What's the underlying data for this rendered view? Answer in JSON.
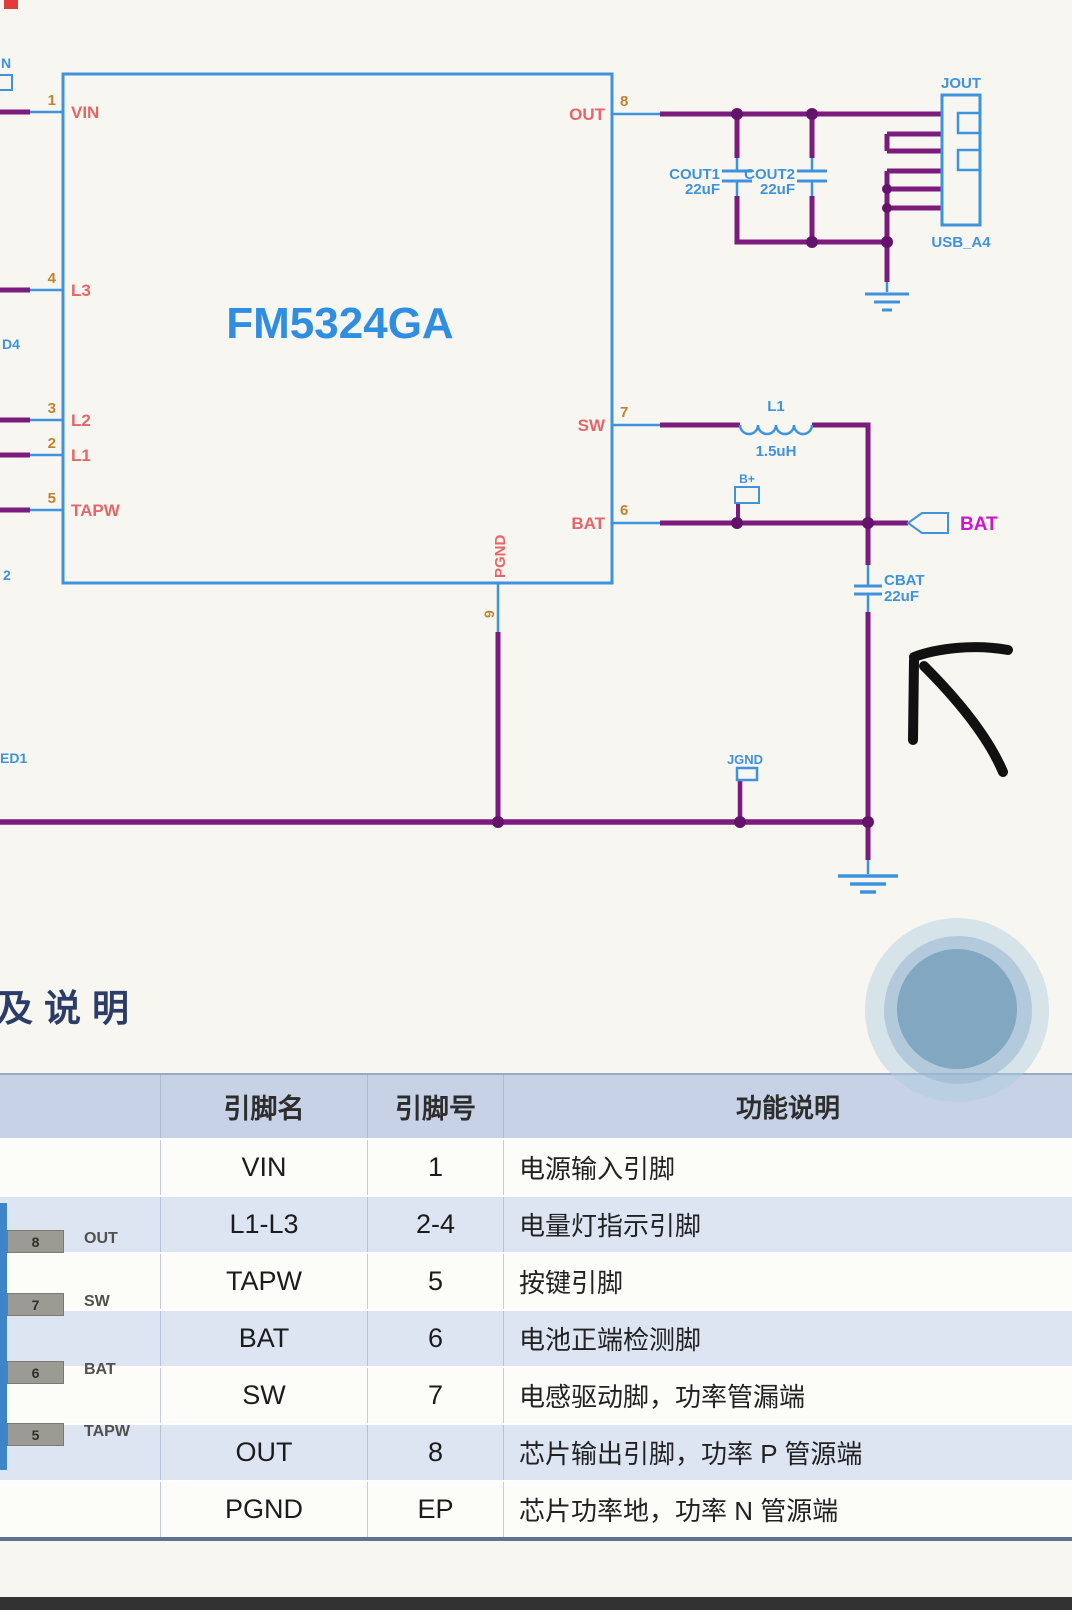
{
  "schematic": {
    "ic_title": "FM5324GA",
    "pins": {
      "p1": {
        "num": "1",
        "name": "VIN"
      },
      "p4": {
        "num": "4",
        "name": "L3"
      },
      "p3": {
        "num": "3",
        "name": "L2"
      },
      "p2": {
        "num": "2",
        "name": "L1"
      },
      "p5": {
        "num": "5",
        "name": "TAPW"
      },
      "p8": {
        "num": "8",
        "name": "OUT"
      },
      "p7": {
        "num": "7",
        "name": "SW"
      },
      "p6": {
        "num": "6",
        "name": "BAT"
      },
      "p9": {
        "num": "9",
        "name": "PGND"
      }
    },
    "components": {
      "cout1_ref": "COUT1",
      "cout1_val": "22uF",
      "cout2_ref": "COUT2",
      "cout2_val": "22uF",
      "l1_ref": "L1",
      "l1_val": "1.5uH",
      "cbat_ref": "CBAT",
      "cbat_val": "22uF",
      "usb_ref": "JOUT",
      "usb_part": "USB_A4",
      "jgnd_ref": "JGND",
      "bplus": "B+",
      "bat_net": "BAT"
    },
    "edge_fragments": {
      "top": "N",
      "mid": "D4",
      "low": "2",
      "bottom": "ED1"
    }
  },
  "heading": "及说明",
  "table": {
    "headers": [
      "引脚名",
      "引脚号",
      "功能说明"
    ],
    "rows": [
      {
        "name": "VIN",
        "num": "1",
        "desc": "电源输入引脚"
      },
      {
        "name": "L1-L3",
        "num": "2-4",
        "desc": "电量灯指示引脚"
      },
      {
        "name": "TAPW",
        "num": "5",
        "desc": "按键引脚"
      },
      {
        "name": "BAT",
        "num": "6",
        "desc": "电池正端检测脚"
      },
      {
        "name": "SW",
        "num": "7",
        "desc": "电感驱动脚，功率管漏端"
      },
      {
        "name": "OUT",
        "num": "8",
        "desc": "芯片输出引脚，功率 P 管源端"
      },
      {
        "name": "PGND",
        "num": "EP",
        "desc": "芯片功率地，功率 N 管源端"
      }
    ]
  },
  "package": {
    "pins": [
      {
        "num": "8",
        "label": "OUT"
      },
      {
        "num": "7",
        "label": "SW"
      },
      {
        "num": "6",
        "label": "BAT"
      },
      {
        "num": "5",
        "label": "TAPW"
      }
    ]
  },
  "colors": {
    "wire_purple": "#7c1b7e",
    "schematic_blue": "#3f93dd",
    "pin_name_red": "#e56568",
    "pin_num_orange": "#c5812f",
    "bat_magenta": "#d112d1",
    "heading_navy": "#2b3c69",
    "header_bg": "#c7d2e6",
    "row_alt_bg": "#dde5f2"
  }
}
